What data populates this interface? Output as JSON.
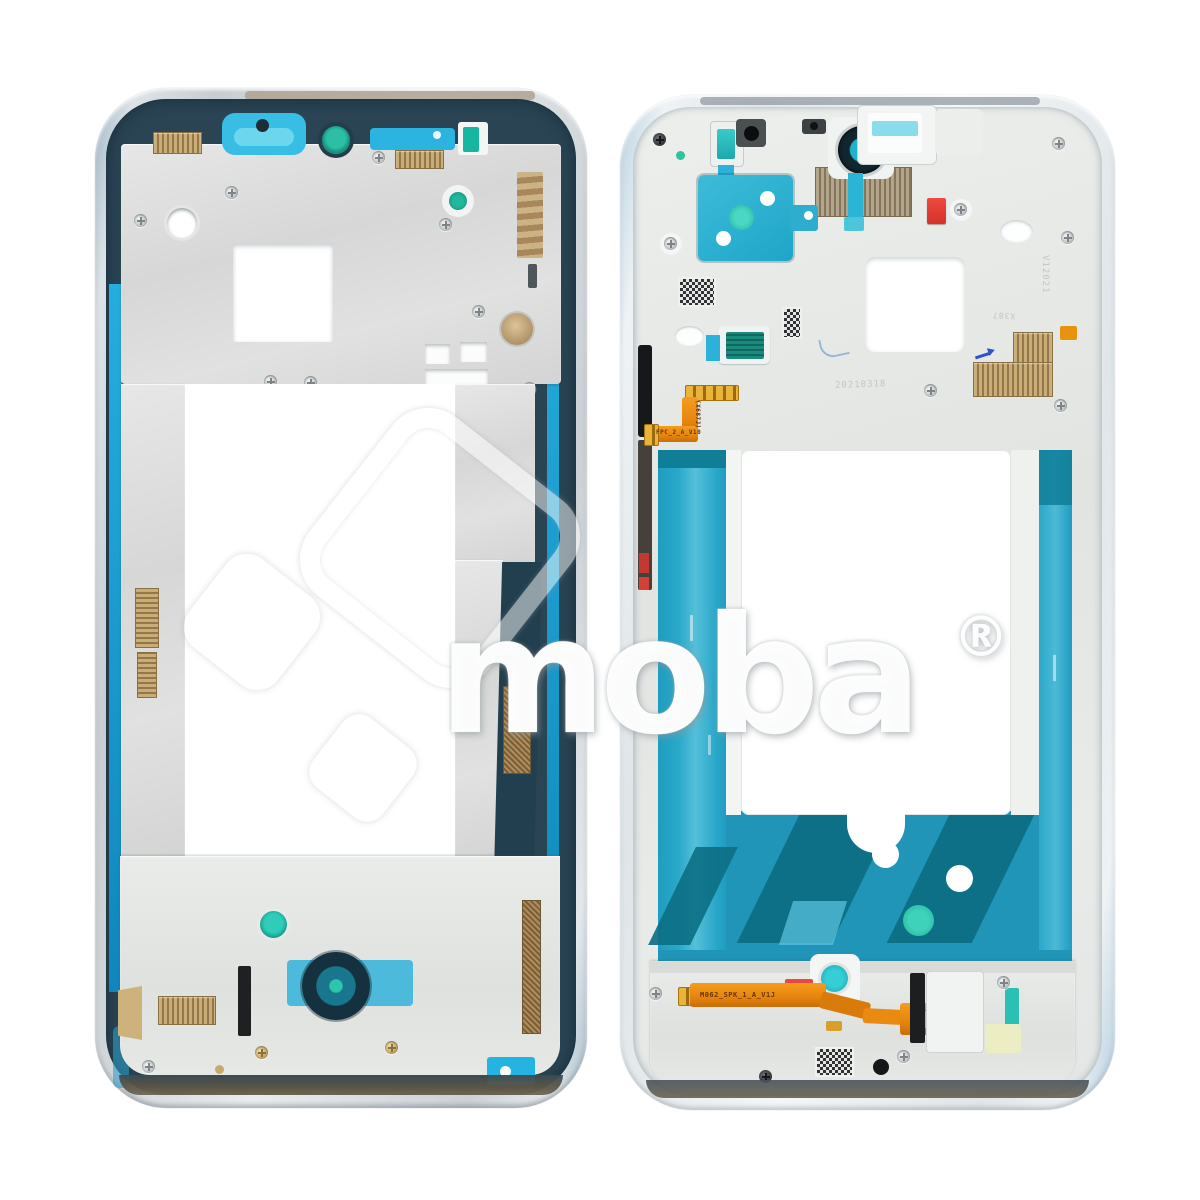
{
  "photo": {
    "subject": "Phone middle-frame housing replacement part, front view (left) and back view (right) on white background",
    "background": "#ffffff"
  },
  "watermark": {
    "brand": "moba",
    "registered": "®"
  },
  "markings": {
    "side_flex_label": "FPC_2_A_V10",
    "side_flex_code": "(X687J)",
    "bottom_flex_label": "M062_SPK_1_A_V1J",
    "etched_date": "20210318",
    "etched_code_vertical": "V12021",
    "etched_code_block": "X387"
  },
  "colors": {
    "adhesive_dark_slate": "#2a4454",
    "adhesive_cyan": "#1ea8da",
    "adhesive_teal": "#2095b8",
    "teal_deep_stripe": "#0d7086",
    "mint_green": "#2cc7ae",
    "flex_orange": "#e8860f",
    "sticker_red": "#d3332a",
    "metal_silver": "#dcdddc",
    "gold_mesh": "#b4995f"
  }
}
